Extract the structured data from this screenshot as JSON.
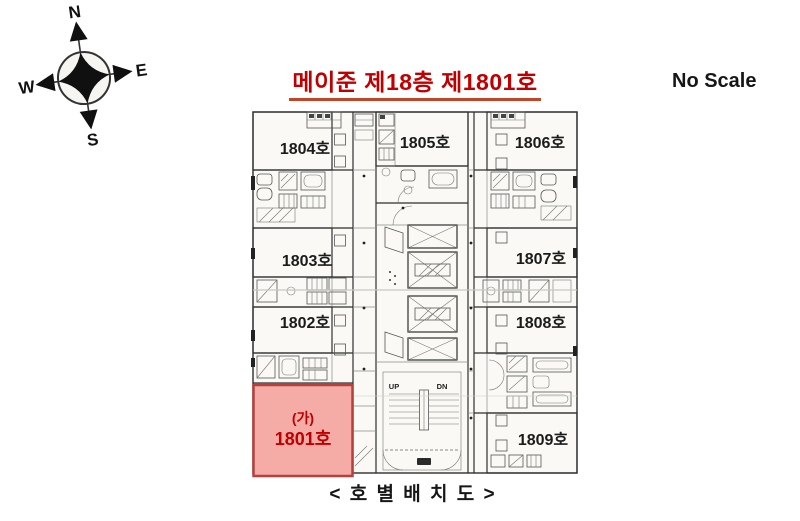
{
  "page": {
    "title": "메이준 제18층 제1801호",
    "no_scale": "No Scale",
    "caption": "< 호 별 배 치 도 >"
  },
  "compass": {
    "north": "N",
    "east": "E",
    "south": "S",
    "west": "W"
  },
  "floor_plan": {
    "units": [
      {
        "id": "1804",
        "label": "1804호"
      },
      {
        "id": "1805",
        "label": "1805호"
      },
      {
        "id": "1806",
        "label": "1806호"
      },
      {
        "id": "1803",
        "label": "1803호"
      },
      {
        "id": "1807",
        "label": "1807호"
      },
      {
        "id": "1802",
        "label": "1802호"
      },
      {
        "id": "1808",
        "label": "1808호"
      },
      {
        "id": "1809",
        "label": "1809호"
      }
    ],
    "highlighted_unit": {
      "mark": "(가)",
      "label": "1801호",
      "fill": "#f5aba6",
      "border": "#b5413c",
      "text_color": "#c00000"
    },
    "stairs": {
      "up": "UP",
      "down": "DN"
    }
  },
  "colors": {
    "title_red": "#c00000",
    "plan_line": "#2f2f2f"
  }
}
